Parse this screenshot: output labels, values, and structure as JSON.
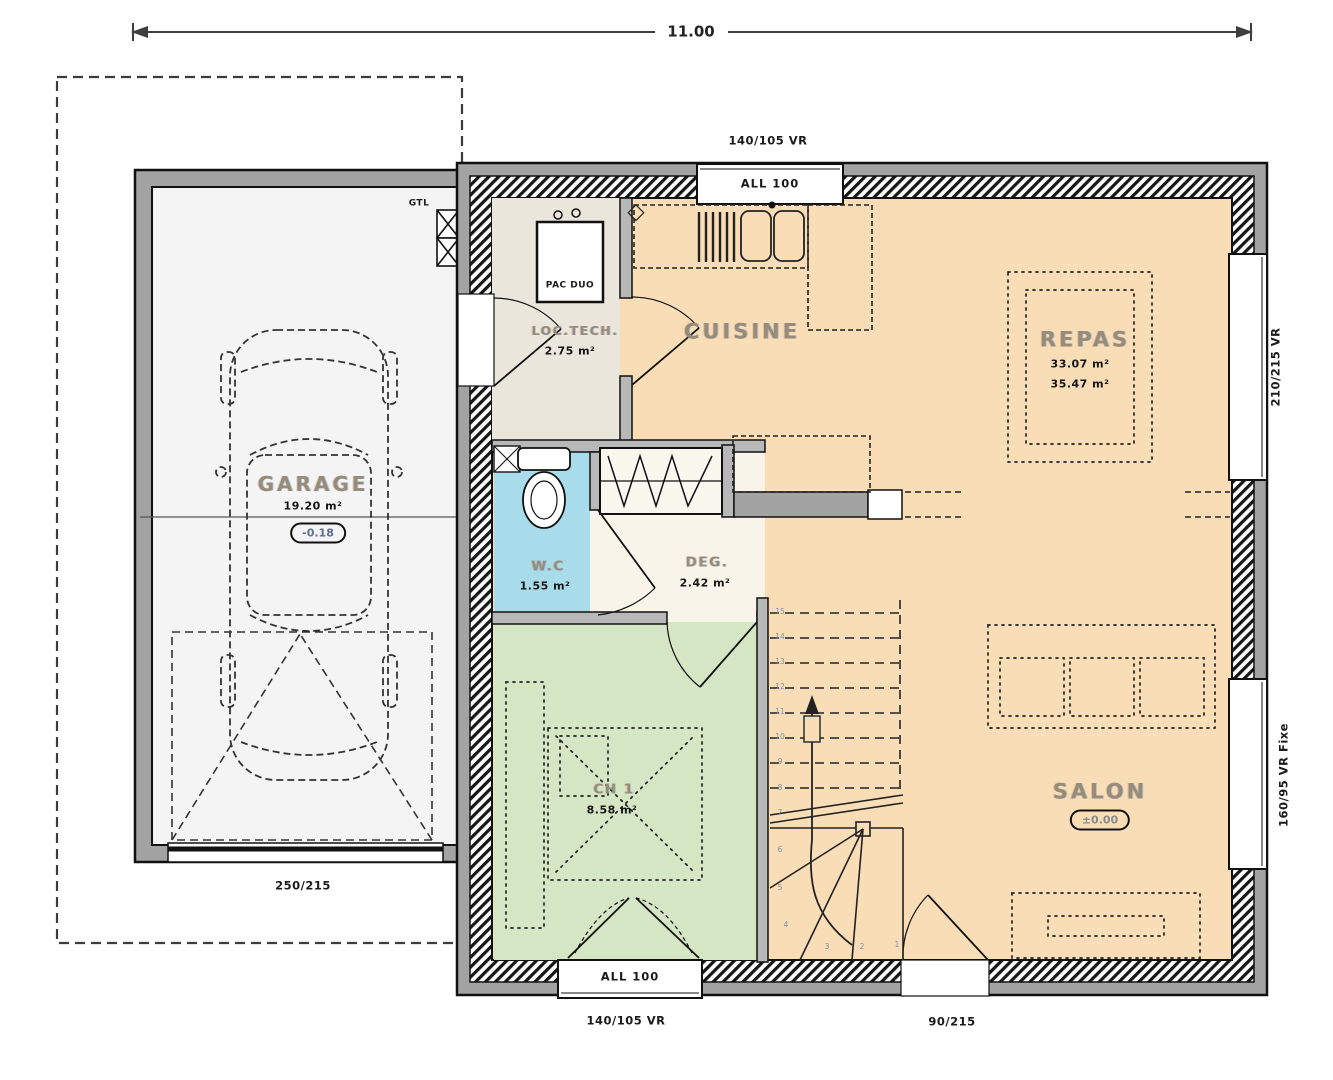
{
  "dimension": {
    "overall": "11.00"
  },
  "openings": {
    "top_size": "140/105 VR",
    "top_sill": "ALL 100",
    "bottom_size": "140/105 VR",
    "bottom_sill": "ALL 100",
    "entry_door": "90/215",
    "garage_door": "250/215",
    "right_top": "210/215 VR",
    "right_bottom": "160/95 VR Fixe"
  },
  "equipment": {
    "gtl": "GTL",
    "pac": "PAC DUO"
  },
  "rooms": {
    "garage": {
      "name": "GARAGE",
      "area": "19.20 m²",
      "level": "-0.18"
    },
    "loctech": {
      "name": "LOC.TECH.",
      "area": "2.75 m²"
    },
    "cuisine": {
      "name": "CUISINE"
    },
    "repas": {
      "name": "REPAS",
      "area_a": "33.07 m²",
      "area_b": "35.47 m²"
    },
    "wc": {
      "name": "W.C",
      "area": "1.55 m²"
    },
    "deg": {
      "name": "DEG.",
      "area": "2.42 m²"
    },
    "ch1": {
      "name": "CH 1",
      "area": "8.58 m²"
    },
    "salon": {
      "name": "SALON",
      "level": "±0.00"
    }
  },
  "stairs": {
    "step_numbers": [
      "1",
      "2",
      "3",
      "4",
      "5",
      "6",
      "7",
      "8",
      "9",
      "10",
      "11",
      "12",
      "13",
      "14",
      "15"
    ]
  },
  "colors": {
    "living": "#f8ddb6",
    "bedroom": "#d4e6c4",
    "wc": "#a9dcea",
    "tech": "#ebe6db",
    "deg": "#f8f4e9",
    "garage_floor": "#f4f4f4",
    "wall_gray": "#a3a3a3",
    "line": "#111111"
  }
}
